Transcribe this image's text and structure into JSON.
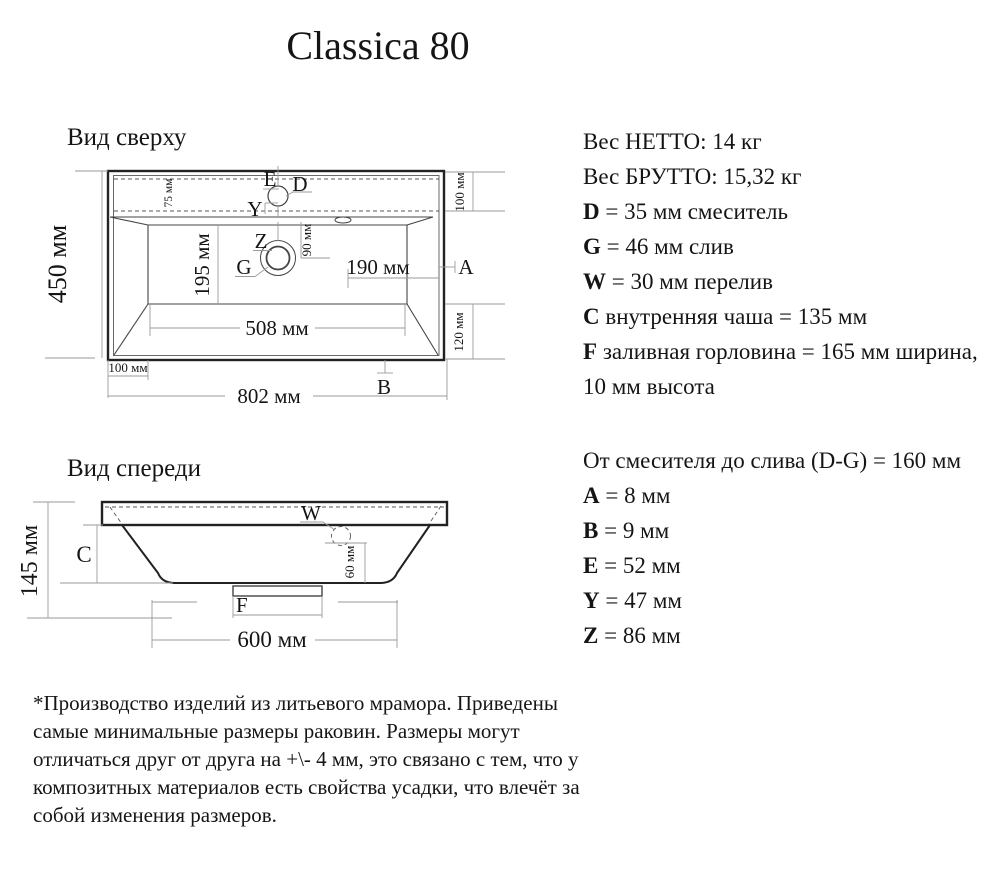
{
  "title": "Classica 80",
  "top_view": {
    "label": "Вид сверху",
    "d450": "450 мм",
    "d75": "75 мм",
    "d90": "90 мм",
    "d195": "195 мм",
    "d190": "190 мм",
    "d508": "508 мм",
    "d802": "802 мм",
    "d100_top_right": "100 мм",
    "d120": "120 мм",
    "d100_bottom": "100 мм",
    "lE": "E",
    "lD": "D",
    "lY": "Y",
    "lZ": "Z",
    "lG": "G",
    "lA": "A",
    "lB": "B"
  },
  "front_view": {
    "label": "Вид спереди",
    "d145": "145 мм",
    "d60": "60 мм",
    "d600": "600 мм",
    "lC": "C",
    "lW": "W",
    "lF": "F"
  },
  "specs1": {
    "l1": {
      "b": "",
      "t": "Вес НЕТТО: 14 кг"
    },
    "l2": {
      "b": "",
      "t": "Вес БРУТТО: 15,32 кг"
    },
    "l3": {
      "b": "D",
      "t": " = 35 мм смеситель"
    },
    "l4": {
      "b": "G",
      "t": " = 46 мм слив"
    },
    "l5": {
      "b": "W",
      "t": " = 30 мм перелив"
    },
    "l6": {
      "b": "C",
      "t": " внутренняя чаша = 135 мм"
    },
    "l7": {
      "b": "F",
      "t": " заливная горловина = 165 мм ширина,"
    },
    "l8": {
      "b": "",
      "t": "10 мм высота"
    }
  },
  "specs2": {
    "l1": {
      "b": "",
      "t": "От смесителя до слива (D-G) = 160 мм"
    },
    "l2": {
      "b": "A",
      "t": " = 8 мм"
    },
    "l3": {
      "b": "B",
      "t": " = 9 мм"
    },
    "l4": {
      "b": "E",
      "t": " = 52 мм"
    },
    "l5": {
      "b": "Y",
      "t": " = 47 мм"
    },
    "l6": {
      "b": "Z",
      "t": " = 86 мм"
    }
  },
  "footnote": {
    "l1": "*Производство изделий из литьевого мрамора. Приведены",
    "l2": "самые минимальные размеры раковин. Размеры могут",
    "l3": "отличаться друг от друга на +\\- 4 мм, это связано с тем, что у",
    "l4": "композитных материалов есть свойства усадки, что влечёт за",
    "l5": "собой изменения размеров."
  }
}
